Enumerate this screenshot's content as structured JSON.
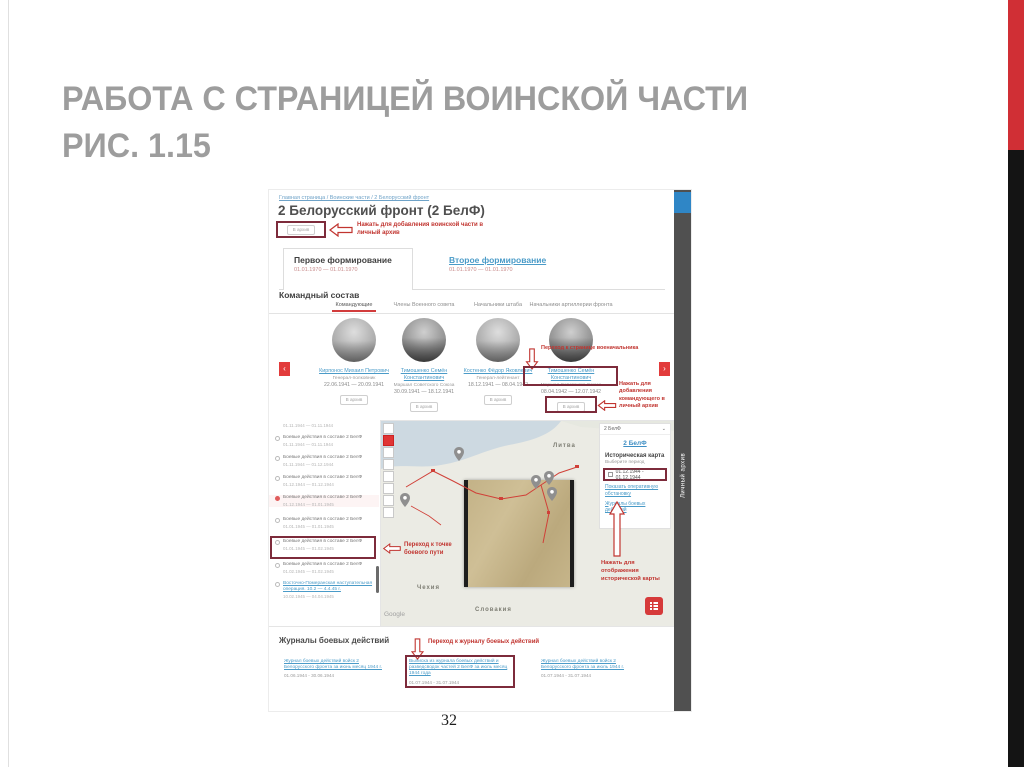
{
  "slide": {
    "title_line1": "РАБОТА С СТРАНИЦЕЙ ВОИНСКОЙ ЧАСТИ",
    "title_line2": "РИС. 1.15",
    "page_number": "32"
  },
  "shot": {
    "breadcrumb": "Главная страница / Воинские части / 2 Белорусский фронт",
    "title": "2 Белорусский фронт (2 БелФ)",
    "archive_button_label": "В архив",
    "annotations": {
      "add_unit": "Нажать для добавления воинской части в личный архив",
      "commander_page": "Переход к странице военачальника",
      "add_commander": "Нажать для добавления командующего в личный архив",
      "route_point": "Переход к точке боевого пути",
      "historic_map": "Нажать для отображения исторической карты",
      "journal": "Переход к журналу боевых действий"
    },
    "formations": {
      "first": {
        "label": "Первое формирование",
        "dates": "01.01.1970 — 01.01.1970"
      },
      "second": {
        "label": "Второе формирование",
        "dates": "01.01.1970 — 01.01.1970"
      }
    },
    "command": {
      "heading": "Командный состав",
      "tabs": [
        "Командующие",
        "Члены Военного совета",
        "Начальники штаба",
        "Начальники артиллерии фронта"
      ],
      "commanders": [
        {
          "name": "Кирпонос Михаил Петрович",
          "rank": "Генерал-полковник",
          "dates": "22.06.1941 — 20.09.1941"
        },
        {
          "name": "Тимошенко Семён Константинович",
          "rank": "Маршал Советского Союза",
          "dates": "30.09.1941 — 18.12.1941"
        },
        {
          "name": "Костенко Фёдор Яковлевич",
          "rank": "Генерал-лейтенант",
          "dates": "18.12.1941 — 08.04.1942"
        },
        {
          "name": "Тимошенко Семён Константинович",
          "rank": "Маршал Советского Союза",
          "dates": "08.04.1942 — 12.07.1942"
        }
      ]
    },
    "battle_list": {
      "partial_dates": "01.11.1944 — 01.11.1944",
      "items": [
        {
          "text": "Боевые действия в составе 2 БелФ",
          "dates": "01.11.1944 — 01.11.1944"
        },
        {
          "text": "Боевые действия в составе 2 БелФ",
          "dates": "01.11.1944 — 01.12.1944"
        },
        {
          "text": "Боевые действия в составе 2 БелФ",
          "dates": "01.12.1944 — 01.12.1944"
        },
        {
          "text": "Боевые действия в составе 2 БелФ",
          "dates": "01.12.1944 — 01.01.1945"
        },
        {
          "text": "Боевые действия в составе 2 БелФ",
          "dates": "01.01.1945 — 01.01.1945"
        },
        {
          "text": "Боевые действия в составе 2 БелФ",
          "dates": "01.01.1945 — 01.02.1945"
        },
        {
          "text": "Боевые действия в составе 2 БелФ",
          "dates": "01.02.1945 — 01.02.1945"
        }
      ],
      "operation": {
        "text": "Восточно-Померанская наступательная операция. 10.2 — 4.4.45 г.",
        "dates": "10.02.1945 — 04.04.1945"
      }
    },
    "map": {
      "dropdown_value": "2 БелФ",
      "labels": {
        "lithuania": "Литва",
        "czechia": "Чехия",
        "slovakia": "Словакия",
        "attribution": "Google"
      },
      "panel": {
        "unit_link": "2 БелФ",
        "historic_title": "Историческая карта",
        "period_hint": "Выберите период",
        "period_value": "01.12.1944 - 01.12.1944",
        "link_situation": "Показать оперативную обстановку",
        "link_journals": "Журналы боевых действий"
      }
    },
    "journals": {
      "heading": "Журналы боевых действий",
      "items": [
        {
          "title": "Журнал боевых действий войск 2 Белорусского фронта за июнь месяц 1944 г.",
          "dates": "01.06.1944 - 30.06.1944"
        },
        {
          "title": "Выписка из журнала боевых действий и разведсводок частей 2 БелФ за июль месяц 1944 года",
          "dates": "01.07.1944 - 31.07.1944"
        },
        {
          "title": "Журнал боевых действий войск 2 Белорусского фронта за июль 1944 г.",
          "dates": "01.07.1944 - 31.07.1944"
        }
      ]
    },
    "right_strip": {
      "label": "Личный архив"
    }
  }
}
